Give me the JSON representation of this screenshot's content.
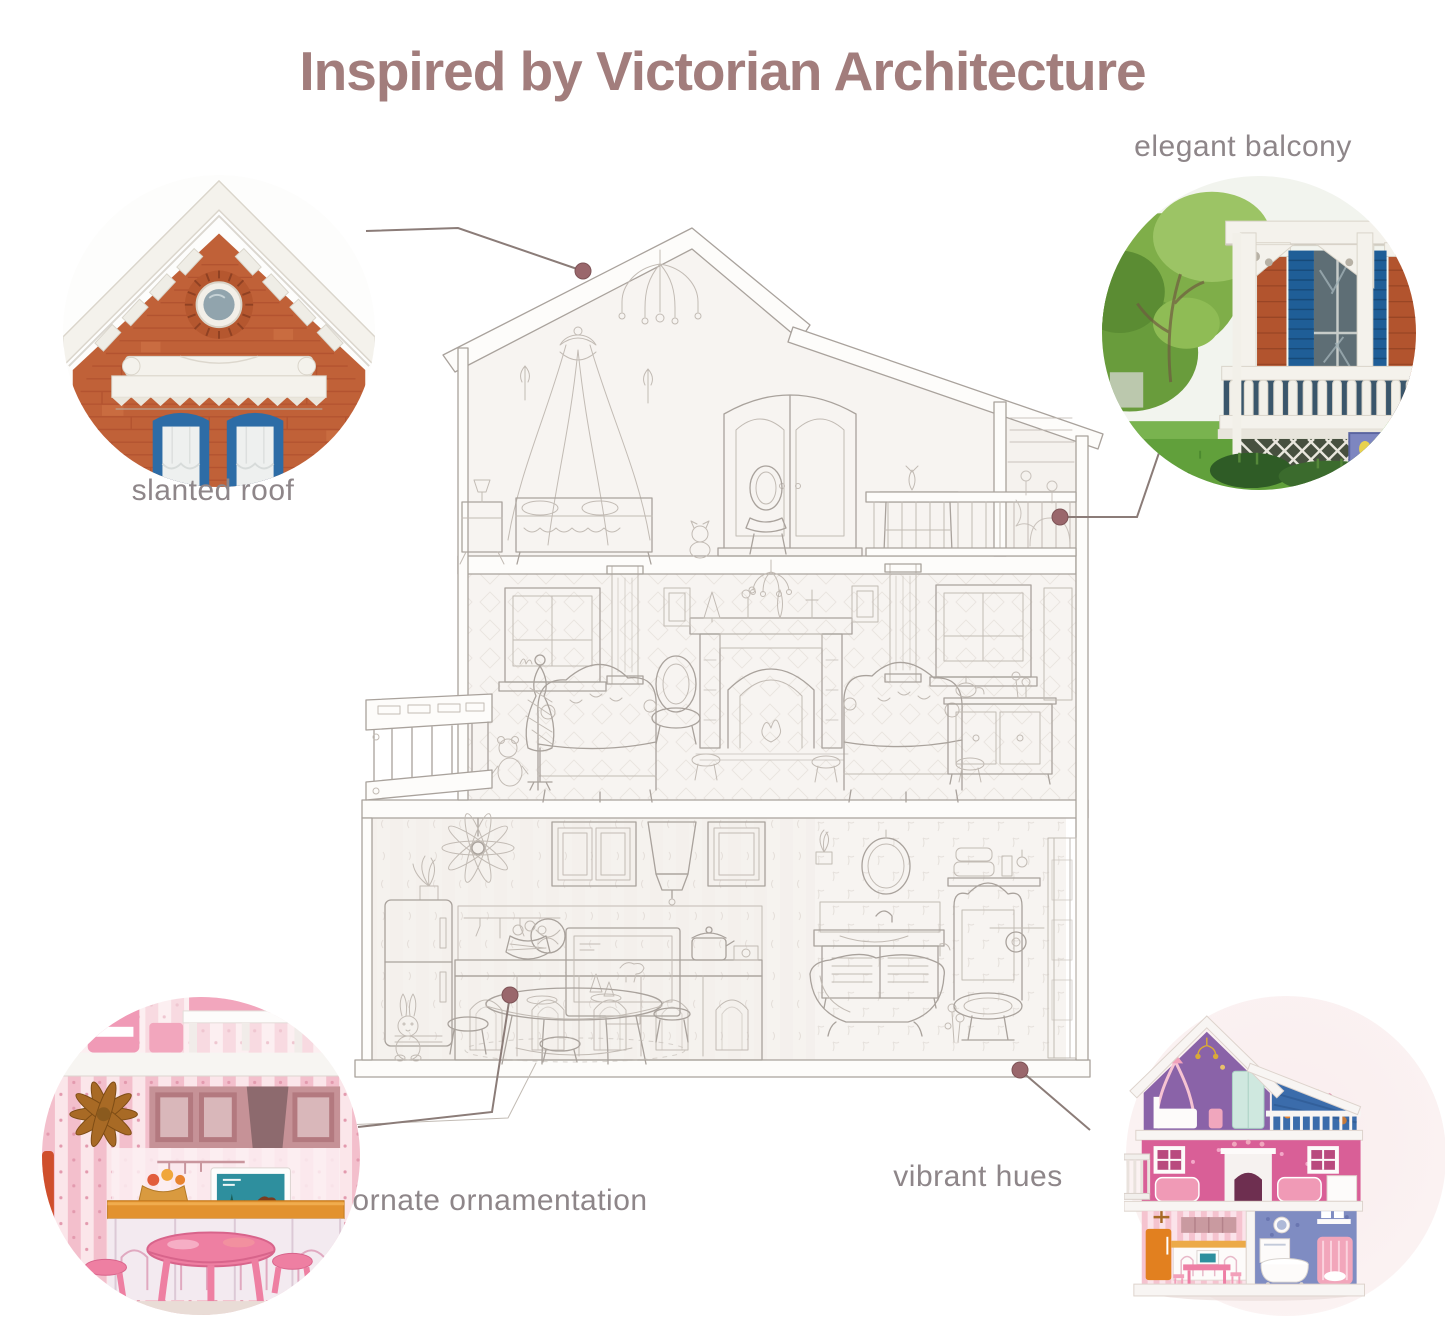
{
  "title": "Inspired by Victorian Architecture",
  "callouts": {
    "slanted_roof": {
      "label": "slanted roof"
    },
    "elegant_balcony": {
      "label": "elegant balcony"
    },
    "ornate_ornamentation": {
      "label": "ornate ornamentation"
    },
    "vibrant_hues": {
      "label": "vibrant hues"
    }
  },
  "colors": {
    "title_color": "#a27d7c",
    "label_color": "#8e8689",
    "connector_color": "#8b7c78",
    "dot_color": "#9a676c",
    "sketch_stroke": "#a9a29c",
    "brick_red": "#c06138",
    "shutter_blue": "#2d6ca6",
    "grass_green": "#61a03b",
    "foliage_green": "#7fae49",
    "dollhouse_pink": "#d95f97",
    "dollhouse_purple": "#8a63a8",
    "attic_blue": "#3b6cab",
    "fridge_orange": "#e2801f",
    "kitchen_pink": "#f5c3cf",
    "backdrop_blush": "#f9edee"
  }
}
